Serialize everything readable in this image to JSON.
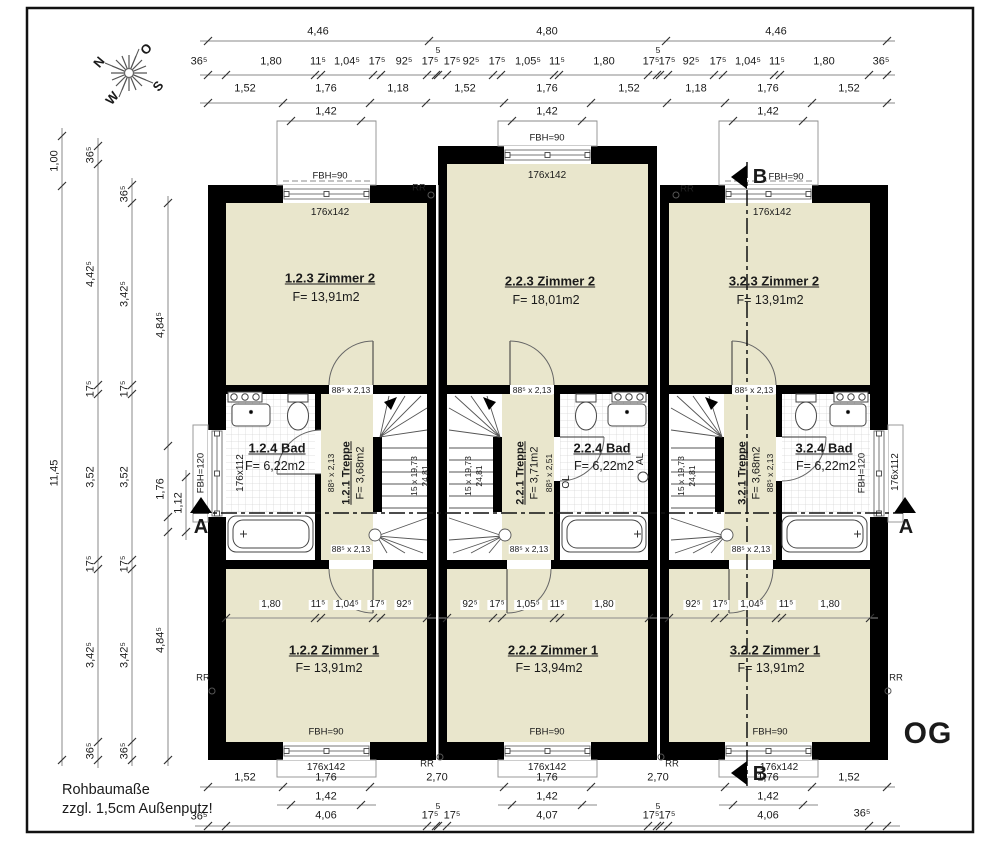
{
  "compass": {
    "n": "N",
    "e": "O",
    "s": "S",
    "w": "W"
  },
  "floor_label": "OG",
  "notes": {
    "line1": "Rohbaumaße",
    "line2": "zzgl. 1,5cm Außenputz!"
  },
  "sections": {
    "a": "A",
    "b": "B"
  },
  "rr_label": "RR",
  "dims": {
    "t1": [
      "4,46",
      "4,80",
      "4,46"
    ],
    "t2": [
      "36⁵",
      "1,80",
      "11⁵",
      "1,04⁵",
      "17⁵",
      "92⁵",
      "17⁵",
      "5",
      "17⁵",
      "92⁵",
      "17⁵",
      "1,05⁵",
      "11⁵",
      "1,80",
      "17⁵",
      "5",
      "17⁵",
      "92⁵",
      "17⁵",
      "1,04⁵",
      "11⁵",
      "1,80",
      "36⁵"
    ],
    "t3": [
      "1,52",
      "1,76",
      "1,18",
      "1,52",
      "1,76",
      "1,52",
      "1,18",
      "1,76",
      "1,52"
    ],
    "t4": [
      "1,42",
      "1,42",
      "1,42"
    ],
    "l1": [
      "1,00",
      "11,45"
    ],
    "l2": [
      "36⁵",
      "4,42⁵",
      "17⁵",
      "3,52",
      "17⁵",
      "3,42⁵",
      "36⁵"
    ],
    "l3": [
      "36⁵",
      "3,42⁵",
      "17⁵",
      "3,52",
      "17⁵",
      "3,42⁵",
      "36⁵"
    ],
    "l4": [
      "4,84⁵",
      "1,76",
      "4,84⁵"
    ],
    "l5": [
      "1,12"
    ],
    "b1": [
      "1,52",
      "1,76",
      "2,70",
      "1,76",
      "2,70",
      "1,76",
      "1,52"
    ],
    "b2": [
      "1,42",
      "1,42",
      "1,42"
    ],
    "b3": [
      "36⁵",
      "4,06",
      "17⁵",
      "5",
      "17⁵",
      "4,07",
      "17⁵",
      "5",
      "17⁵",
      "4,06",
      "36⁵"
    ],
    "i1": [
      "1,80",
      "11⁵",
      "1,04⁵",
      "17⁵",
      "92⁵"
    ],
    "i2": [
      "92⁵",
      "17⁵",
      "1,05⁵",
      "11⁵",
      "1,80"
    ],
    "i3": [
      "92⁵",
      "17⁵",
      "1,04⁵",
      "11⁵",
      "1,80"
    ]
  },
  "houses": [
    {
      "zimmer2_name": "1.2.3 Zimmer 2",
      "zimmer2_area": "F= 13,91m2",
      "bad_name": "1.2.4 Bad",
      "bad_area": "F= 6,22m2",
      "treppe_name": "1.2.1 Treppe",
      "treppe_area": "F= 3,68m2",
      "bad_door": "88⁵ x 2,13",
      "door_top": "88⁵ x 2,13",
      "door_bottom": "88⁵ x 2,13",
      "stair_run": "15 x 19,73",
      "stair_going": "24,81",
      "zimmer1_name": "1.2.2 Zimmer 1",
      "zimmer1_area": "F= 13,91m2",
      "window_top": "176x142",
      "window_bottom": "176x142",
      "fbh_top": "FBH=90",
      "fbh_bottom": "FBH=90"
    },
    {
      "zimmer2_name": "2.2.3 Zimmer 2",
      "zimmer2_area": "F= 18,01m2",
      "bad_name": "2.2.4 Bad",
      "bad_area": "F= 6,22m2",
      "treppe_name": "2.2.1 Treppe",
      "treppe_area": "F= 3,71m2",
      "bad_door": "88⁵ x 2,51",
      "door_top": "88⁵ x 2,13",
      "door_bottom": "88⁵ x 2,13",
      "stair_run": "15 x 19,73",
      "stair_going": "24,81",
      "ol": "OL",
      "al": "AL",
      "zimmer1_name": "2.2.2 Zimmer 1",
      "zimmer1_area": "F= 13,94m2",
      "window_top": "176x142",
      "window_bottom": "176x142",
      "fbh_top": "FBH=90",
      "fbh_bottom": "FBH=90"
    },
    {
      "zimmer2_name": "3.2.3 Zimmer 2",
      "zimmer2_area": "F= 13,91m2",
      "bad_name": "3.2.4 Bad",
      "bad_area": "F= 6,22m2",
      "treppe_name": "3.2.1 Treppe",
      "treppe_area": "F= 3,68m2",
      "bad_door": "88⁵ x 2,13",
      "door_top": "88⁵ x 2,13",
      "door_bottom": "88⁵ x 2,13",
      "stair_run": "15 x 19,73",
      "stair_going": "24,81",
      "zimmer1_name": "3.2.2 Zimmer 1",
      "zimmer1_area": "F= 13,91m2",
      "window_top": "176x142",
      "window_bottom": "176x142",
      "fbh_top": "FBH=90",
      "fbh_bottom": "FBH=90"
    }
  ],
  "side_windows": {
    "left_fbh": "FBH=120",
    "left_size": "176x112",
    "right_fbh": "FBH=120",
    "right_size": "176x112"
  },
  "colors": {
    "room_fill": "#e9e6cc",
    "wall": "#000000",
    "dim_line": "#8a8a8a"
  }
}
